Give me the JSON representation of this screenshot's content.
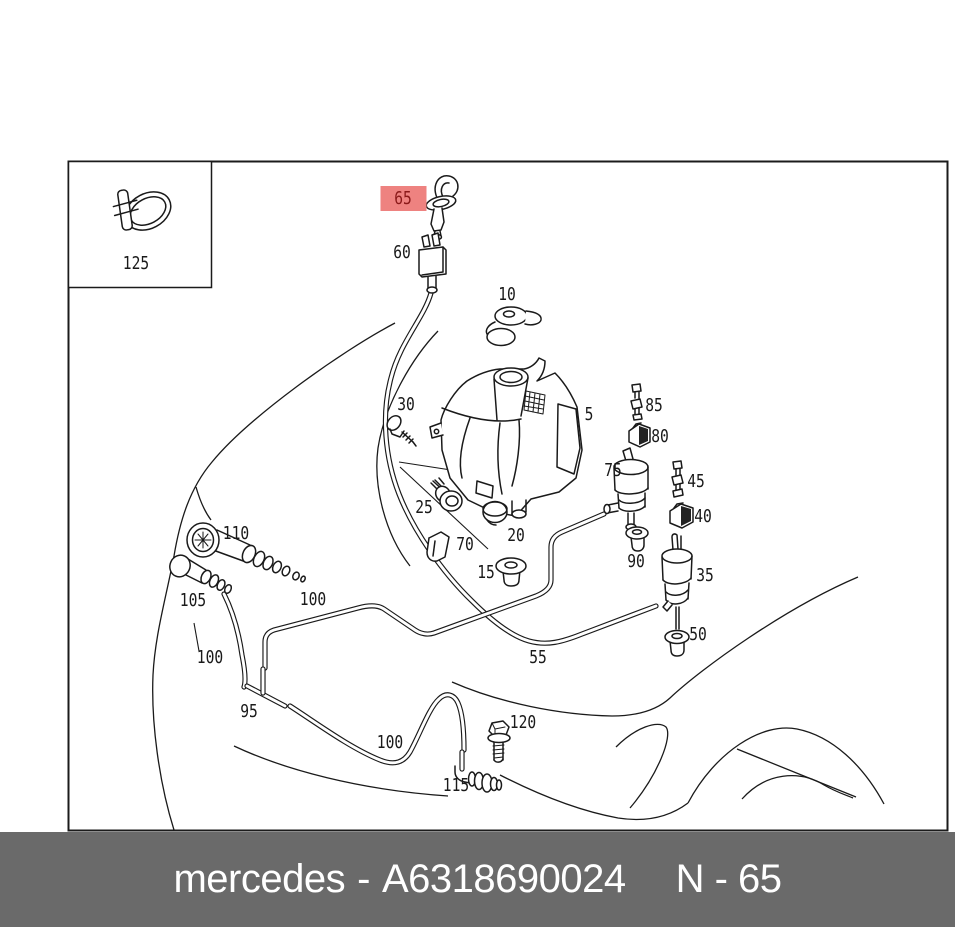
{
  "diagram": {
    "ink": "#1a1a1a",
    "background": "#ffffff",
    "border_color": "#1b1b1b",
    "highlight": {
      "label": "65",
      "bg": "#ee8280",
      "text_color": "#8b1a1a"
    },
    "labels": [
      {
        "text": "125",
        "x": 136,
        "y": 269,
        "highlighted": false
      },
      {
        "text": "65",
        "x": 403,
        "y": 204,
        "highlighted": true
      },
      {
        "text": "60",
        "x": 402,
        "y": 258,
        "highlighted": false
      },
      {
        "text": "10",
        "x": 507,
        "y": 300,
        "highlighted": false
      },
      {
        "text": "5",
        "x": 589,
        "y": 420,
        "highlighted": false
      },
      {
        "text": "30",
        "x": 406,
        "y": 410,
        "highlighted": false
      },
      {
        "text": "85",
        "x": 654,
        "y": 411,
        "highlighted": false
      },
      {
        "text": "80",
        "x": 660,
        "y": 442,
        "highlighted": false
      },
      {
        "text": "75",
        "x": 613,
        "y": 476,
        "highlighted": false
      },
      {
        "text": "45",
        "x": 696,
        "y": 487,
        "highlighted": false
      },
      {
        "text": "40",
        "x": 703,
        "y": 522,
        "highlighted": false
      },
      {
        "text": "25",
        "x": 424,
        "y": 513,
        "highlighted": false
      },
      {
        "text": "20",
        "x": 516,
        "y": 541,
        "highlighted": false
      },
      {
        "text": "70",
        "x": 465,
        "y": 550,
        "highlighted": false
      },
      {
        "text": "15",
        "x": 486,
        "y": 578,
        "highlighted": false
      },
      {
        "text": "90",
        "x": 636,
        "y": 567,
        "highlighted": false
      },
      {
        "text": "35",
        "x": 705,
        "y": 581,
        "highlighted": false
      },
      {
        "text": "50",
        "x": 698,
        "y": 640,
        "highlighted": false
      },
      {
        "text": "110",
        "x": 236,
        "y": 539,
        "highlighted": false
      },
      {
        "text": "105",
        "x": 193,
        "y": 606,
        "highlighted": false
      },
      {
        "text": "100",
        "x": 210,
        "y": 663,
        "highlighted": false
      },
      {
        "text": "100",
        "x": 313,
        "y": 605,
        "highlighted": false
      },
      {
        "text": "100",
        "x": 390,
        "y": 748,
        "highlighted": false
      },
      {
        "text": "95",
        "x": 249,
        "y": 717,
        "highlighted": false
      },
      {
        "text": "55",
        "x": 538,
        "y": 663,
        "highlighted": false
      },
      {
        "text": "120",
        "x": 523,
        "y": 728,
        "highlighted": false
      },
      {
        "text": "115",
        "x": 456,
        "y": 791,
        "highlighted": false
      }
    ]
  },
  "footer": {
    "brand": "mercedes",
    "separator": "-",
    "part_number": "A6318690024",
    "reference": "N - 65",
    "bar_color": "#6a6a6a",
    "text_color": "#ffffff"
  }
}
